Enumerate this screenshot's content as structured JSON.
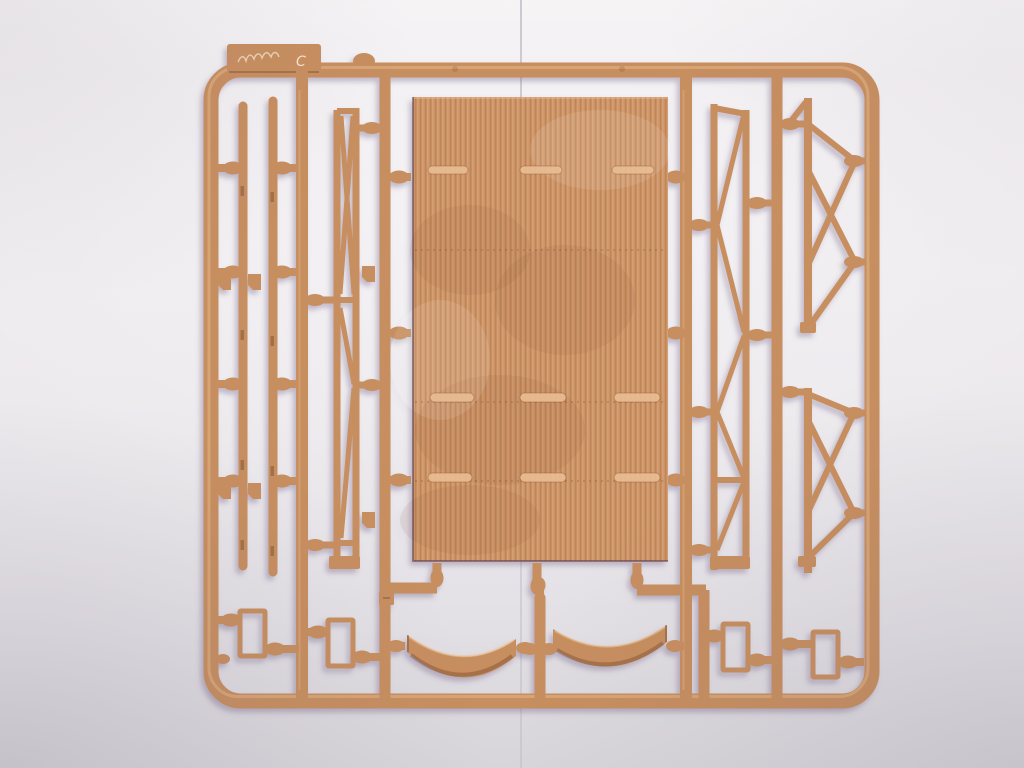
{
  "scene": {
    "type": "photograph",
    "subject": "tan injection-molded plastic model-kit sprue (parts tree) lying on a pale grey-lavender surface",
    "tab_engraving": "C"
  },
  "colors": {
    "plastic": "#c78e5e",
    "plastic_dark": "#9a6a3d",
    "plastic_light": "#ecc394",
    "panel": "#cd9365",
    "shadow": "#6f5f85",
    "background_top": "#f4f1f3",
    "background_mid": "#eae7eb",
    "background_bottom": "#d8d5da"
  },
  "parts": [
    {
      "name": "ribbed-side-panel",
      "count": 1
    },
    {
      "name": "long-side-rail-post",
      "count": 2
    },
    {
      "name": "lattice-truss-frame",
      "count": 2
    },
    {
      "name": "x-braced-frame",
      "count": 2
    },
    {
      "name": "small-rectangular-frame",
      "count": 4
    },
    {
      "name": "curved-tilt-end",
      "count": 2
    },
    {
      "name": "small-angle-bracket",
      "count": 6
    }
  ]
}
